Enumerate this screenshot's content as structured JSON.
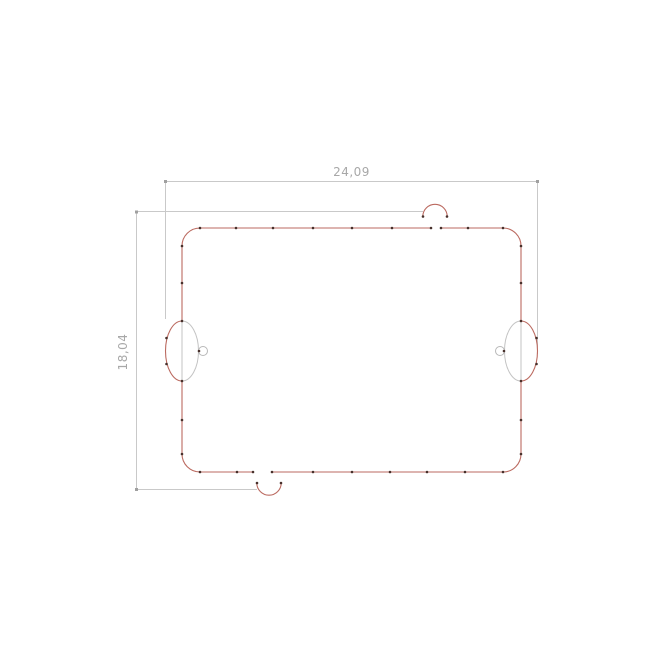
{
  "drawing": {
    "type": "cad-outline-preview",
    "dimensions": {
      "width_label": "24,09",
      "height_label": "18,04"
    },
    "colors": {
      "cut_outline": "#bb6a60",
      "aux_geometry": "#c3c3c3",
      "dimension_line": "#c9c9c9",
      "dimension_text": "#a8a8a8",
      "node_mark": "#47302b",
      "background": "#ffffff"
    },
    "features": {
      "outline": "rounded-rectangle cut path with two edge gaps",
      "left_feature": "ellipse grommet with small circle, bulging outward on left edge",
      "right_feature": "ellipse grommet with small circle, bulging outward on right edge",
      "top_notch": "semicircular arc above top edge gap",
      "bottom_notch": "semicircular arc below bottom edge gap"
    }
  }
}
